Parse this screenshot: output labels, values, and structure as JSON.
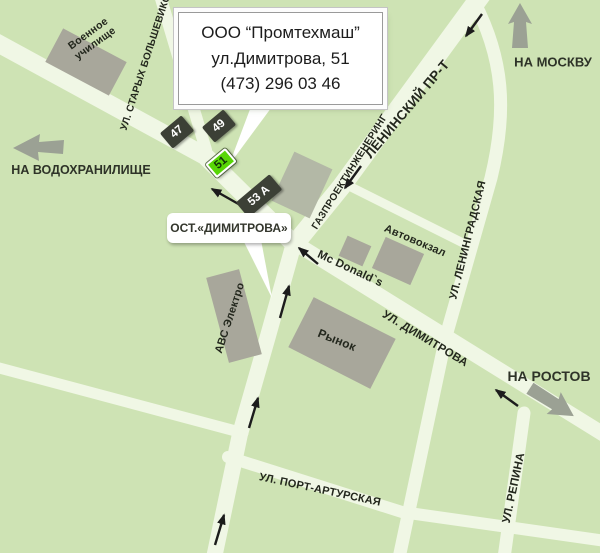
{
  "info_box": {
    "company": "ООО “Промтехмаш”",
    "address": "ул.Димитрова, 51",
    "phone": "(473) 296 03 46"
  },
  "bus_stop": {
    "label": "ОСТ.«ДИМИТРОВА»"
  },
  "directions": {
    "moscow": "НА МОСКВУ",
    "reservoir": "НА ВОДОХРАНИЛИЩЕ",
    "rostov": "НА РОСТОВ"
  },
  "streets": {
    "staryh_bolshevikov": "УЛ. СТАРЫХ БОЛЬШЕВИКОВ",
    "leninsky": "ЛЕНИНСКИЙ ПР-Т",
    "gazproektinzhenering": "ГАЗПРОЕКТИНЖЕНЕРИНГ",
    "leningradskaya": "УЛ. ЛЕНИНГРАДСКАЯ",
    "dimitrova": "УЛ. ДИМИТРОВА",
    "port_arturskaya": "УЛ. ПОРТ-АРТУРСКАЯ",
    "repina": "УЛ. РЕПИНА"
  },
  "places": {
    "military_school": "Военное\nучилище",
    "bus_terminal": "Автовокзал",
    "mcdonalds": "Mc Donald`s",
    "market": "Рынок",
    "avs_electro": "АВС Электро"
  },
  "house_numbers": {
    "h47": "47",
    "h49": "49",
    "h51": "51",
    "h53a": "53 А"
  },
  "colors": {
    "background": "#cee3b4",
    "road": "#f0f7e5",
    "building": "#a8a79b",
    "badge_dark": "#3c4036",
    "badge_highlight": "#58d606",
    "arrow_gray": "#9ba194",
    "arrow_black": "#1c1c1c"
  }
}
